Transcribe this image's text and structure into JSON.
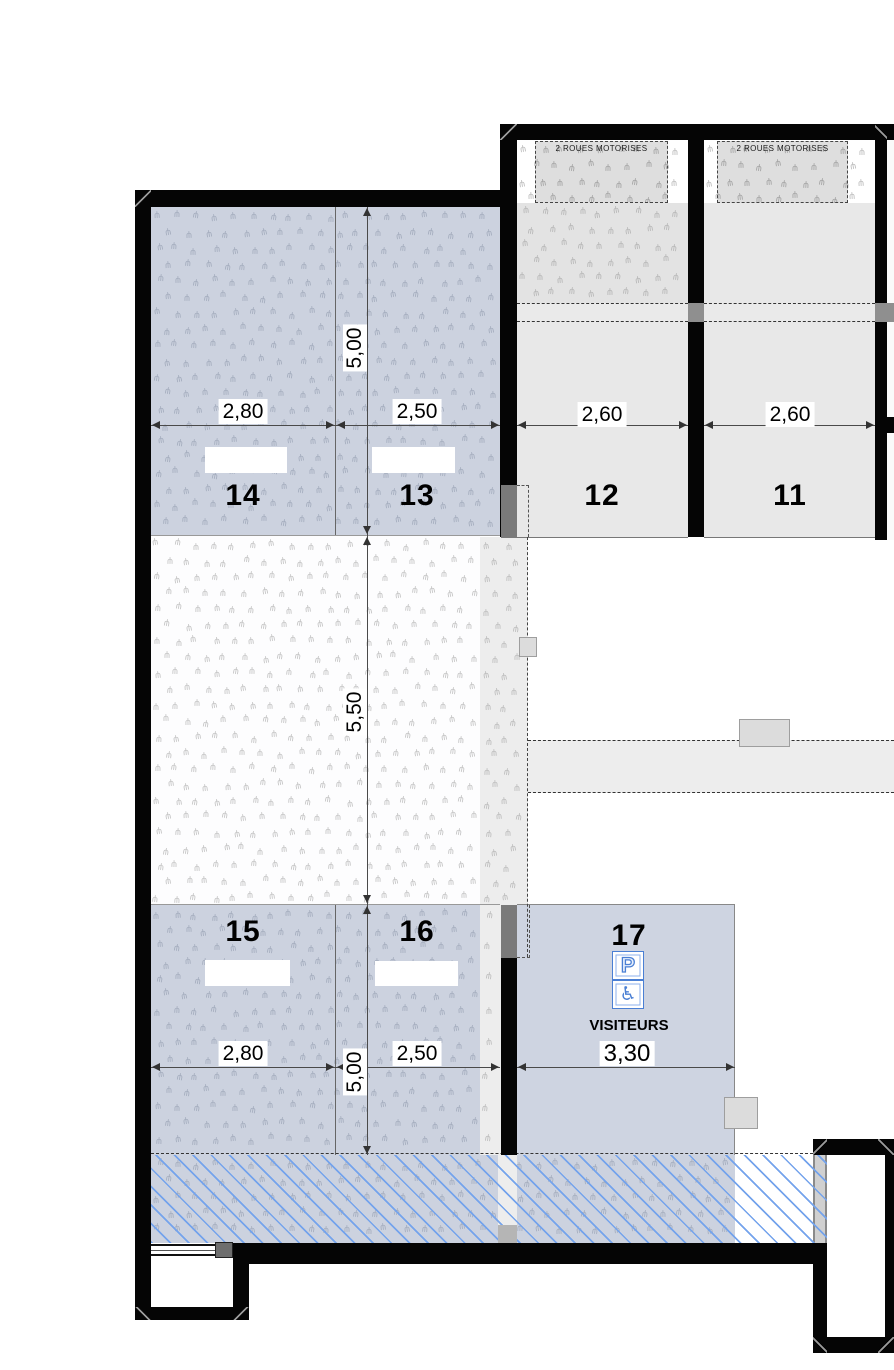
{
  "plan": {
    "moto_zone_label": "2 ROUES MOTORISES",
    "spaces": {
      "s11": {
        "number": "11",
        "width": "2,60"
      },
      "s12": {
        "number": "12",
        "width": "2,60"
      },
      "s13": {
        "number": "13",
        "width": "2,50"
      },
      "s14": {
        "number": "14",
        "width": "2,80"
      },
      "s15": {
        "number": "15",
        "width": "2,80"
      },
      "s16": {
        "number": "16",
        "width": "2,50"
      },
      "s17": {
        "number": "17",
        "width": "3,30",
        "label": "VISITEURS"
      }
    },
    "dims": {
      "row_top_depth": "5,00",
      "aisle_depth": "5,50",
      "row_bottom_depth": "5,00"
    },
    "icons": {
      "parking_sign": "P",
      "wheelchair": "♿"
    },
    "colors": {
      "space_fill_blue": "#ccd2df",
      "bay_fill_gray": "#e8e8e8",
      "hatch_blue": "#74a3ec",
      "wall_black": "#050505",
      "sign_blue": "#4a7fd4"
    }
  }
}
